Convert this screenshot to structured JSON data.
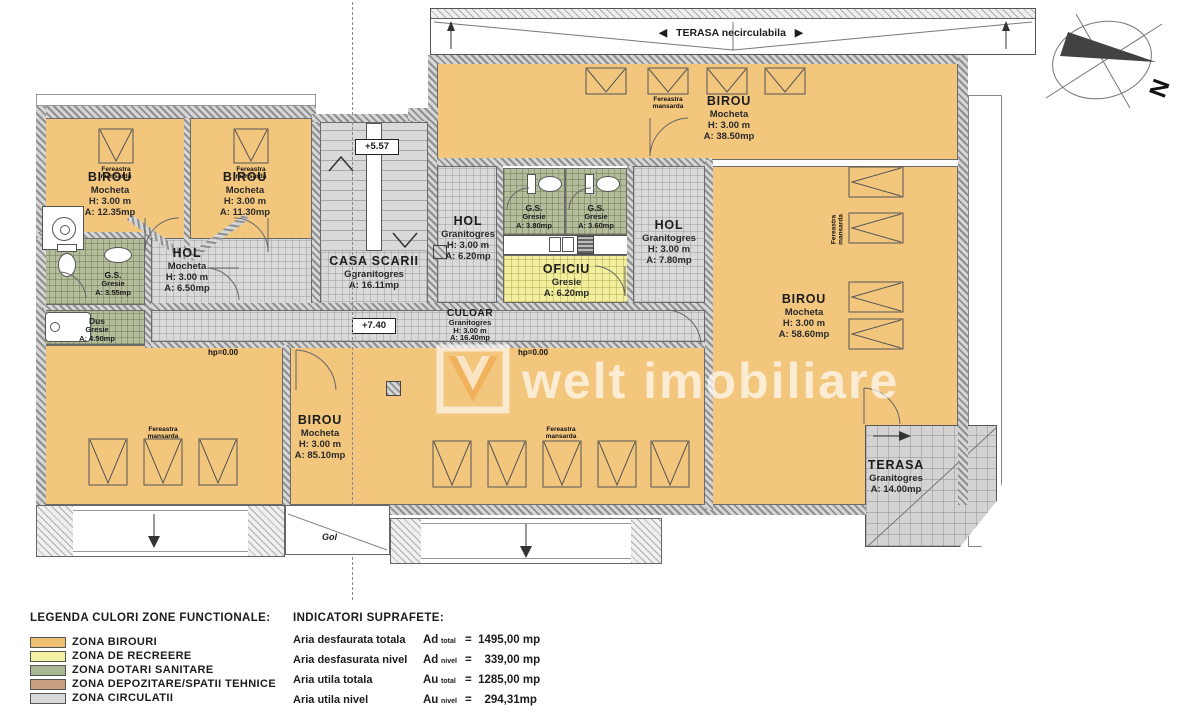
{
  "plan": {
    "compass": {
      "label": "N"
    },
    "terrace_top": {
      "label": "TERASA necirculabila",
      "arrow_left": "◀",
      "arrow_right": "▶"
    },
    "markers": {
      "level_upper": "+5.57",
      "level_corridor": "+7.40",
      "hp_left": "hp=0.00",
      "hp_center": "hp=0.00",
      "gol": "Gol"
    },
    "window_label": "Fereastra mansarda",
    "rooms": {
      "birou_tl1": {
        "name": "BIROU",
        "finish": "Mocheta",
        "height": "H: 3.00 m",
        "area": "A: 12.35mp"
      },
      "birou_tl2": {
        "name": "BIROU",
        "finish": "Mocheta",
        "height": "H: 3.00 m",
        "area": "A: 11.30mp"
      },
      "hol_left": {
        "name": "HOL",
        "finish": "Mocheta",
        "height": "H: 3.00 m",
        "area": "A: 6.50mp"
      },
      "gs_left": {
        "name": "G.S.",
        "finish": "Gresie",
        "area": "A: 3.55mp"
      },
      "dus": {
        "name": "Dus",
        "finish": "Gresie",
        "area": "A: 4.50mp"
      },
      "casa_scarii": {
        "name": "CASA SCARII",
        "finish": "Ggranitogres",
        "area": "A: 16.11mp"
      },
      "hol_center": {
        "name": "HOL",
        "finish": "Granitogres",
        "height": "H: 3.00 m",
        "area": "A: 6.20mp"
      },
      "gs_center_left": {
        "name": "G.S.",
        "finish": "Gresie",
        "area": "A: 3.80mp"
      },
      "gs_center_right": {
        "name": "G.S.",
        "finish": "Gresie",
        "area": "A: 3.60mp"
      },
      "oficiu": {
        "name": "OFICIU",
        "finish": "Gresie",
        "area": "A: 6.20mp"
      },
      "hol_right": {
        "name": "HOL",
        "finish": "Granitogres",
        "height": "H: 3.00 m",
        "area": "A: 7.80mp"
      },
      "birou_top": {
        "name": "BIROU",
        "finish": "Mocheta",
        "height": "H: 3.00 m",
        "area": "A: 38.50mp"
      },
      "birou_right": {
        "name": "BIROU",
        "finish": "Mocheta",
        "height": "H: 3.00 m",
        "area": "A: 58.60mp"
      },
      "birou_bottom": {
        "name": "BIROU",
        "finish": "Mocheta",
        "height": "H: 3.00 m",
        "area": "A: 85.10mp"
      },
      "culoar": {
        "name": "CULOAR",
        "finish": "Granitogres",
        "height": "H: 3.00 m",
        "area": "A: 16.40mp"
      },
      "terasa": {
        "name": "TERASA",
        "finish": "Granitogres",
        "area": "A: 14.00mp"
      }
    }
  },
  "watermark": {
    "text": "welt imobiliare"
  },
  "legend": {
    "title": "LEGENDA CULORI ZONE FUNCTIONALE:",
    "items": [
      {
        "label": "ZONA BIROURI",
        "color": "#f0c173"
      },
      {
        "label": "ZONA DE RECREERE",
        "color": "#f5f1a2"
      },
      {
        "label": "ZONA DOTARI SANITARE",
        "color": "#aab795"
      },
      {
        "label": "ZONA DEPOZITARE/SPATII TEHNICE",
        "color": "#c8a183"
      },
      {
        "label": "ZONA CIRCULATII",
        "color": "#d8d8d8"
      }
    ]
  },
  "indicators": {
    "title": "INDICATORI SUPRAFETE:",
    "rows": [
      {
        "label": "Aria desfaurata totala",
        "symbol": "Ad",
        "subscript": "total",
        "value": "=  1495,00 mp"
      },
      {
        "label": "Aria desfasurata nivel",
        "symbol": "Ad",
        "subscript": "nivel",
        "value": "=    339,00 mp"
      },
      {
        "label": "Aria utila totala",
        "symbol": "Au",
        "subscript": "total",
        "value": "=  1285,00 mp"
      },
      {
        "label": "Aria utila nivel",
        "symbol": "Au",
        "subscript": "nivel",
        "value": "=    294,31mp"
      }
    ]
  }
}
